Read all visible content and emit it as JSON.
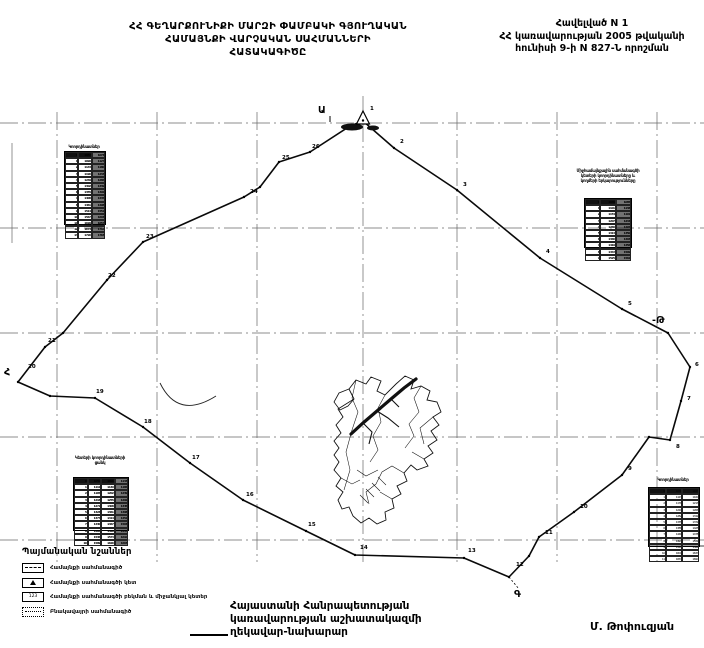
{
  "document": {
    "title_lines": [
      "ՀՀ ԳԵՂԱՐՔՈՒՆԻՔԻ ՄԱՐԶԻ ՓԱՄԲԱԿԻ ԳՅՈՒՂԱԿԱՆ",
      "ՀԱՄԱՅՆՔԻ ՎԱՐՉԱԿԱՆ ՍԱՀՄԱՆՆԵՐԻ",
      "ՀԱՏԱԿԱԳԻԾԸ"
    ],
    "annex_lines": [
      "Հավելված N 1",
      "ՀՀ կառավարության 2005 թվականի",
      "հունիսի 9-ի N 827-Ն որոշման"
    ],
    "footer_lines": [
      "Հայաստանի Հանրապետության",
      "կառավարության աշխատակազմի",
      "ղեկավար-նախարար"
    ],
    "signature": "Մ. Թոփուզյան"
  },
  "legend": {
    "title": "Պայմանական նշաններ",
    "items": [
      {
        "symbol": "community-boundary-line",
        "symbol_text": "",
        "label": "Համայնքի սահմանագիծ"
      },
      {
        "symbol": "community-boundary-point",
        "symbol_text": "",
        "label": "Համայնքի սահմանագծի կետ"
      },
      {
        "symbol": "boundary-point-number",
        "symbol_text": "123",
        "label": "Համայնքի սահմանագծի բեկման և միջանկյալ կետեր"
      },
      {
        "symbol": "settlement-boundary-line",
        "symbol_text": "···",
        "label": "Բնակավայրի սահմանագիծ"
      }
    ]
  },
  "map": {
    "boundary_points": [
      [
        363,
        121
      ],
      [
        394,
        148
      ],
      [
        457,
        190
      ],
      [
        540,
        258
      ],
      [
        622,
        309
      ],
      [
        668,
        333
      ],
      [
        690,
        367
      ],
      [
        681,
        401
      ],
      [
        670,
        440
      ],
      [
        649,
        437
      ],
      [
        622,
        475
      ],
      [
        574,
        512
      ],
      [
        539,
        537
      ],
      [
        529,
        556
      ],
      [
        509,
        577
      ],
      [
        464,
        558
      ],
      [
        355,
        555
      ],
      [
        306,
        531
      ],
      [
        243,
        500
      ],
      [
        190,
        463
      ],
      [
        143,
        427
      ],
      [
        95,
        398
      ],
      [
        50,
        396
      ],
      [
        18,
        382
      ],
      [
        45,
        347
      ],
      [
        63,
        333
      ],
      [
        107,
        280
      ],
      [
        143,
        242
      ],
      [
        244,
        197
      ],
      [
        260,
        187
      ],
      [
        279,
        162
      ],
      [
        310,
        152
      ],
      [
        350,
        126
      ],
      [
        363,
        121
      ]
    ],
    "vertex_labels": [
      {
        "t": "1",
        "x": 370,
        "y": 110
      },
      {
        "t": "2",
        "x": 400,
        "y": 143
      },
      {
        "t": "3",
        "x": 463,
        "y": 186
      },
      {
        "t": "4",
        "x": 546,
        "y": 253
      },
      {
        "t": "5",
        "x": 628,
        "y": 305
      },
      {
        "t": "6",
        "x": 695,
        "y": 366
      },
      {
        "t": "7",
        "x": 687,
        "y": 400
      },
      {
        "t": "8",
        "x": 676,
        "y": 448
      },
      {
        "t": "9",
        "x": 628,
        "y": 470
      },
      {
        "t": "10",
        "x": 580,
        "y": 508
      },
      {
        "t": "11",
        "x": 545,
        "y": 534
      },
      {
        "t": "12",
        "x": 516,
        "y": 566
      },
      {
        "t": "13",
        "x": 468,
        "y": 552
      },
      {
        "t": "14",
        "x": 360,
        "y": 549
      },
      {
        "t": "15",
        "x": 308,
        "y": 526
      },
      {
        "t": "16",
        "x": 246,
        "y": 496
      },
      {
        "t": "17",
        "x": 192,
        "y": 459
      },
      {
        "t": "18",
        "x": 144,
        "y": 423
      },
      {
        "t": "19",
        "x": 96,
        "y": 393
      },
      {
        "t": "20",
        "x": 28,
        "y": 368
      },
      {
        "t": "21",
        "x": 48,
        "y": 342
      },
      {
        "t": "22",
        "x": 108,
        "y": 277
      },
      {
        "t": "23",
        "x": 146,
        "y": 238
      },
      {
        "t": "24",
        "x": 250,
        "y": 193
      },
      {
        "t": "25",
        "x": 282,
        "y": 159
      },
      {
        "t": "26",
        "x": 312,
        "y": 148
      }
    ],
    "direction_letters": [
      {
        "t": "Ա",
        "x": 318,
        "y": 113
      },
      {
        "t": "-Թ",
        "x": 652,
        "y": 323
      },
      {
        "t": "Գ",
        "x": 514,
        "y": 597
      },
      {
        "t": "Հ",
        "x": 4,
        "y": 375
      }
    ],
    "tables": [
      {
        "id": "upper-left",
        "x": 64,
        "y": 151,
        "w": 40,
        "h": 72,
        "rows": 14,
        "cols": 3,
        "dark": true,
        "cap_x": 48,
        "cap_y": 144,
        "cap_w": 72,
        "caption_lines": [
          "Կոորդինատներ"
        ]
      },
      {
        "id": "upper-right",
        "x": 584,
        "y": 198,
        "w": 46,
        "h": 48,
        "rows": 10,
        "cols": 3,
        "dark": true,
        "cap_x": 556,
        "cap_y": 168,
        "cap_w": 104,
        "caption_lines": [
          "Միջհամայնքային սահմանագծի",
          "կետերի կոորդինատները և",
          "կողմերի երկարությունները"
        ]
      },
      {
        "id": "lower-left",
        "x": 73,
        "y": 477,
        "w": 54,
        "h": 52,
        "rows": 11,
        "cols": 4,
        "dark": true,
        "cap_x": 62,
        "cap_y": 455,
        "cap_w": 76,
        "caption_lines": [
          "Կետերի կոորդինատների",
          "ցանկ"
        ]
      },
      {
        "id": "lower-right",
        "x": 648,
        "y": 487,
        "w": 50,
        "h": 58,
        "rows": 12,
        "cols": 3,
        "dark": false,
        "cap_x": 646,
        "cap_y": 477,
        "cap_w": 54,
        "caption_lines": [
          "Կոորդինատներ"
        ]
      }
    ]
  }
}
